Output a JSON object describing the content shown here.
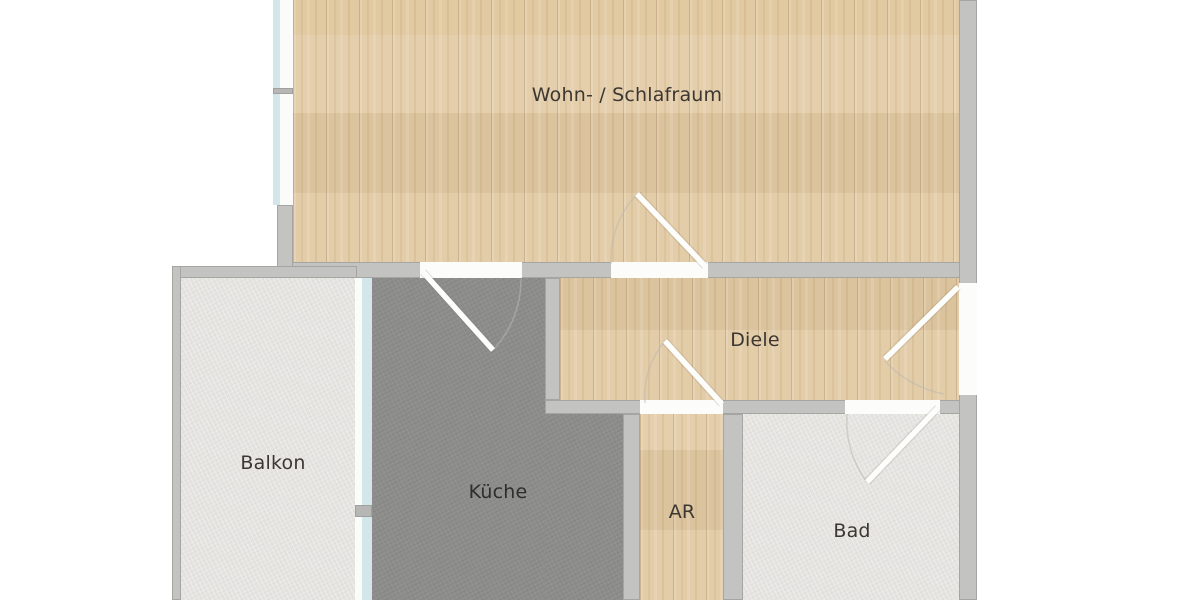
{
  "floorplan": {
    "rooms": [
      {
        "name": "Wohn- / Schlafraum",
        "floor": "wood"
      },
      {
        "name": "Diele",
        "floor": "wood"
      },
      {
        "name": "Balkon",
        "floor": "light-stone"
      },
      {
        "name": "Küche",
        "floor": "dark-stone"
      },
      {
        "name": "AR",
        "floor": "wood"
      },
      {
        "name": "Bad",
        "floor": "light-stone"
      }
    ],
    "doors": [
      {
        "id": "wohn-door",
        "between": "Diele / Wohn- Schlafraum"
      },
      {
        "id": "kueche-door",
        "between": "Küche / Wohn- Schlafraum"
      },
      {
        "id": "ar-door",
        "between": "Diele / AR"
      },
      {
        "id": "bad-door",
        "between": "Diele / Bad"
      },
      {
        "id": "entrance-door",
        "between": "Diele / entrance"
      }
    ],
    "windows": [
      {
        "id": "wohn-window",
        "at": "Wohn- / Schlafraum west wall"
      },
      {
        "id": "balkon-window",
        "at": "Küche / Balkon wall"
      }
    ],
    "colors": {
      "wall": "#c3c3c1",
      "wood": "#e1c9a2",
      "dark_floor": "#8d8d8b",
      "light_floor": "#e5e4e0",
      "glass": "#d3e6e9",
      "door_leaf": "#fdfdfc",
      "label_text": "#3c3731",
      "background": "#ffffff"
    }
  }
}
